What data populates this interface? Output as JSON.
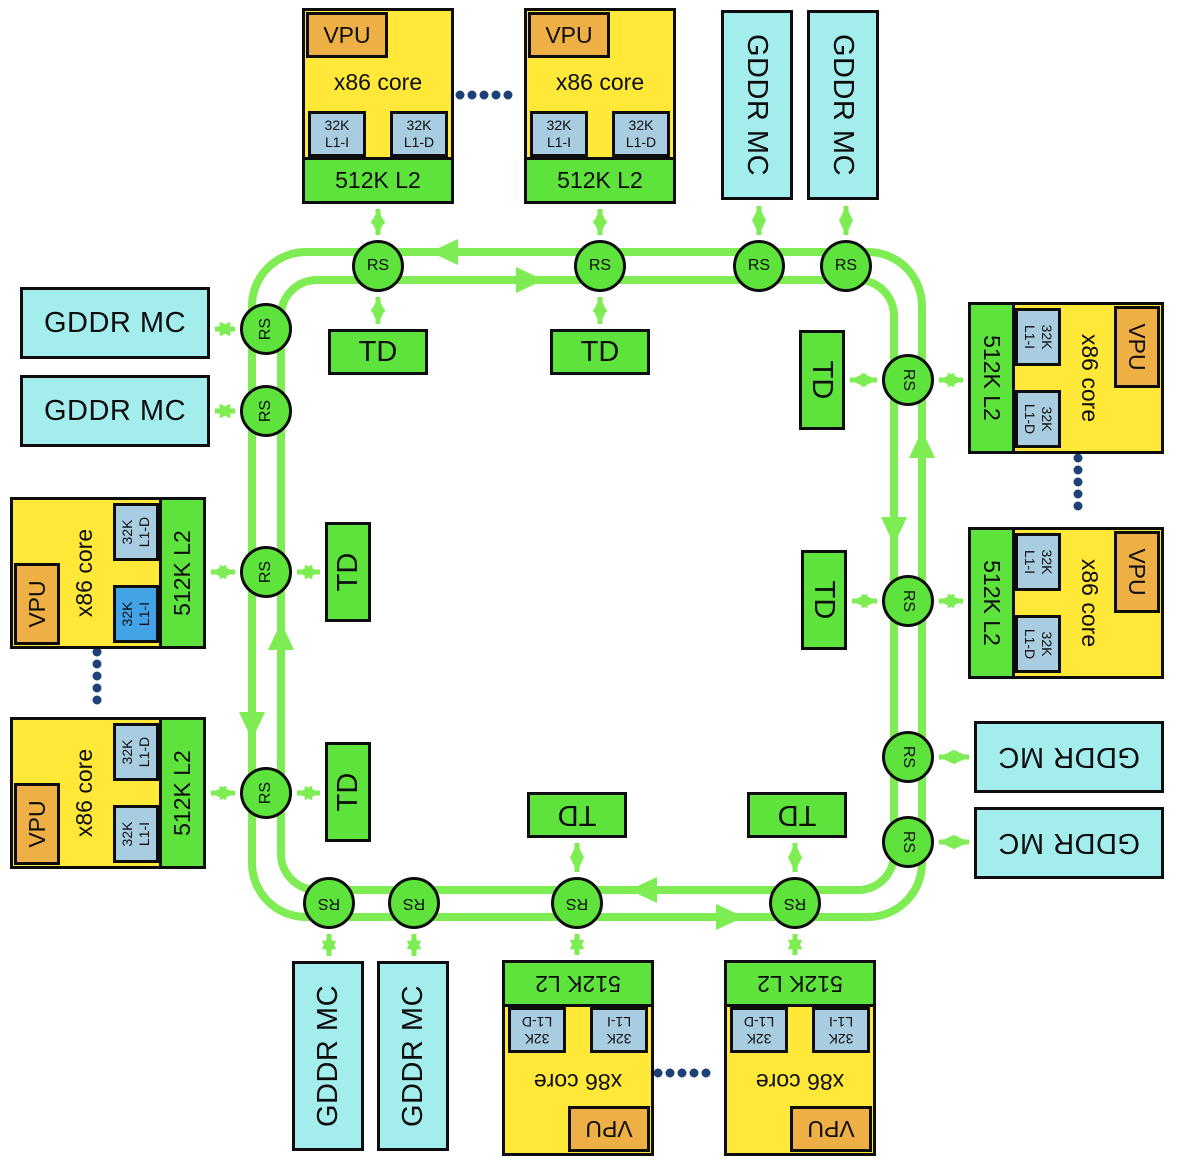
{
  "colors": {
    "tile_yellow": "#ffe838",
    "vpu_orange": "#eeb044",
    "l1_blue": "#a8cde0",
    "l1_highlight_blue": "#42a4e6",
    "block_green": "#5ee33c",
    "ring_green": "#7eed54",
    "gddr_cyan": "#a4eded",
    "dotted_navy": "#1d4076",
    "border_black": "#0d0d0d"
  },
  "blocks": {
    "core_tile": {
      "vpu": "VPU",
      "core": "x86 core",
      "l1i": {
        "size": "32K",
        "name": "L1-I"
      },
      "l1d": {
        "size": "32K",
        "name": "L1-D"
      },
      "l2": "512K L2"
    },
    "gddr_mc": "GDDR MC",
    "td": "TD",
    "rs": "RS"
  }
}
